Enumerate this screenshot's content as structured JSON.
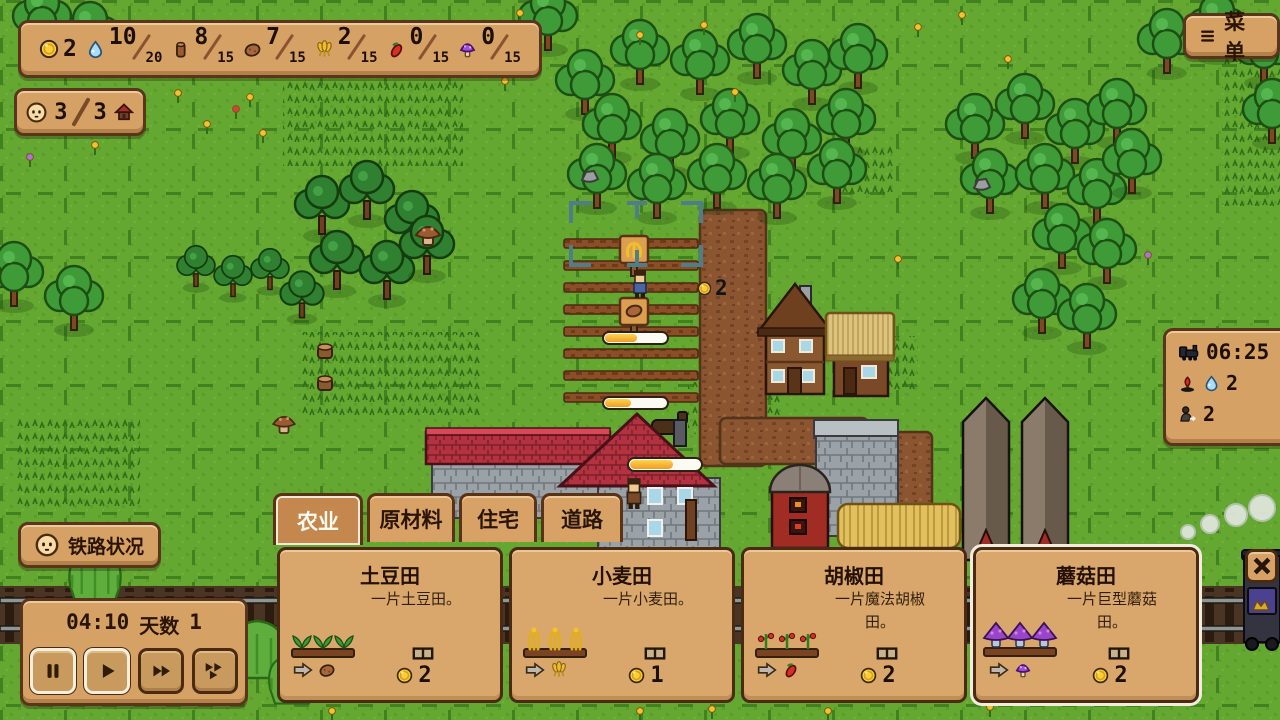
{
  "theme": {
    "panel_tan": "#d6a164",
    "panel_dark": "#cf9055",
    "border_brown": "#5a3215",
    "selected_outline": "#f2ecdc",
    "grass_green": "#64a832",
    "progress_fill": "#f4a930"
  },
  "hud": {
    "resources": {
      "coin": {
        "value": "2"
      },
      "water": {
        "current": "10",
        "max": "20"
      },
      "wood": {
        "current": "8",
        "max": "15"
      },
      "potato": {
        "current": "7",
        "max": "15"
      },
      "wheat": {
        "current": "2",
        "max": "15"
      },
      "pepper": {
        "current": "0",
        "max": "15"
      },
      "mushroom": {
        "current": "0",
        "max": "15"
      }
    },
    "population": {
      "current": "3",
      "max": "3"
    },
    "menu_button_label": "菜单",
    "train_schedule": {
      "time": "06:25",
      "water_demand": "2",
      "passengers": "2"
    },
    "railway_status_label": "铁路状况",
    "time_panel": {
      "clock": "04:10",
      "day_label": "天数",
      "day_value": "1"
    }
  },
  "world": {
    "coin_popup": "2",
    "crop_progress": [
      {
        "pct": 52
      },
      {
        "pct": 42
      },
      {
        "pct": 62
      }
    ]
  },
  "build_panel": {
    "tabs": [
      {
        "label": "农业",
        "selected": true
      },
      {
        "label": "原材料",
        "selected": false
      },
      {
        "label": "住宅",
        "selected": false
      },
      {
        "label": "道路",
        "selected": false
      }
    ],
    "cards": [
      {
        "name": "土豆田",
        "desc": "一片土豆田。",
        "cost": "2",
        "produces": "potato",
        "selected": false
      },
      {
        "name": "小麦田",
        "desc": "一片小麦田。",
        "cost": "1",
        "produces": "wheat",
        "selected": false
      },
      {
        "name": "胡椒田",
        "desc": "一片魔法胡椒田。",
        "cost": "2",
        "produces": "pepper",
        "selected": false
      },
      {
        "name": "蘑菇田",
        "desc": "一片巨型蘑菇田。",
        "cost": "2",
        "produces": "mushroom",
        "selected": true
      }
    ]
  }
}
